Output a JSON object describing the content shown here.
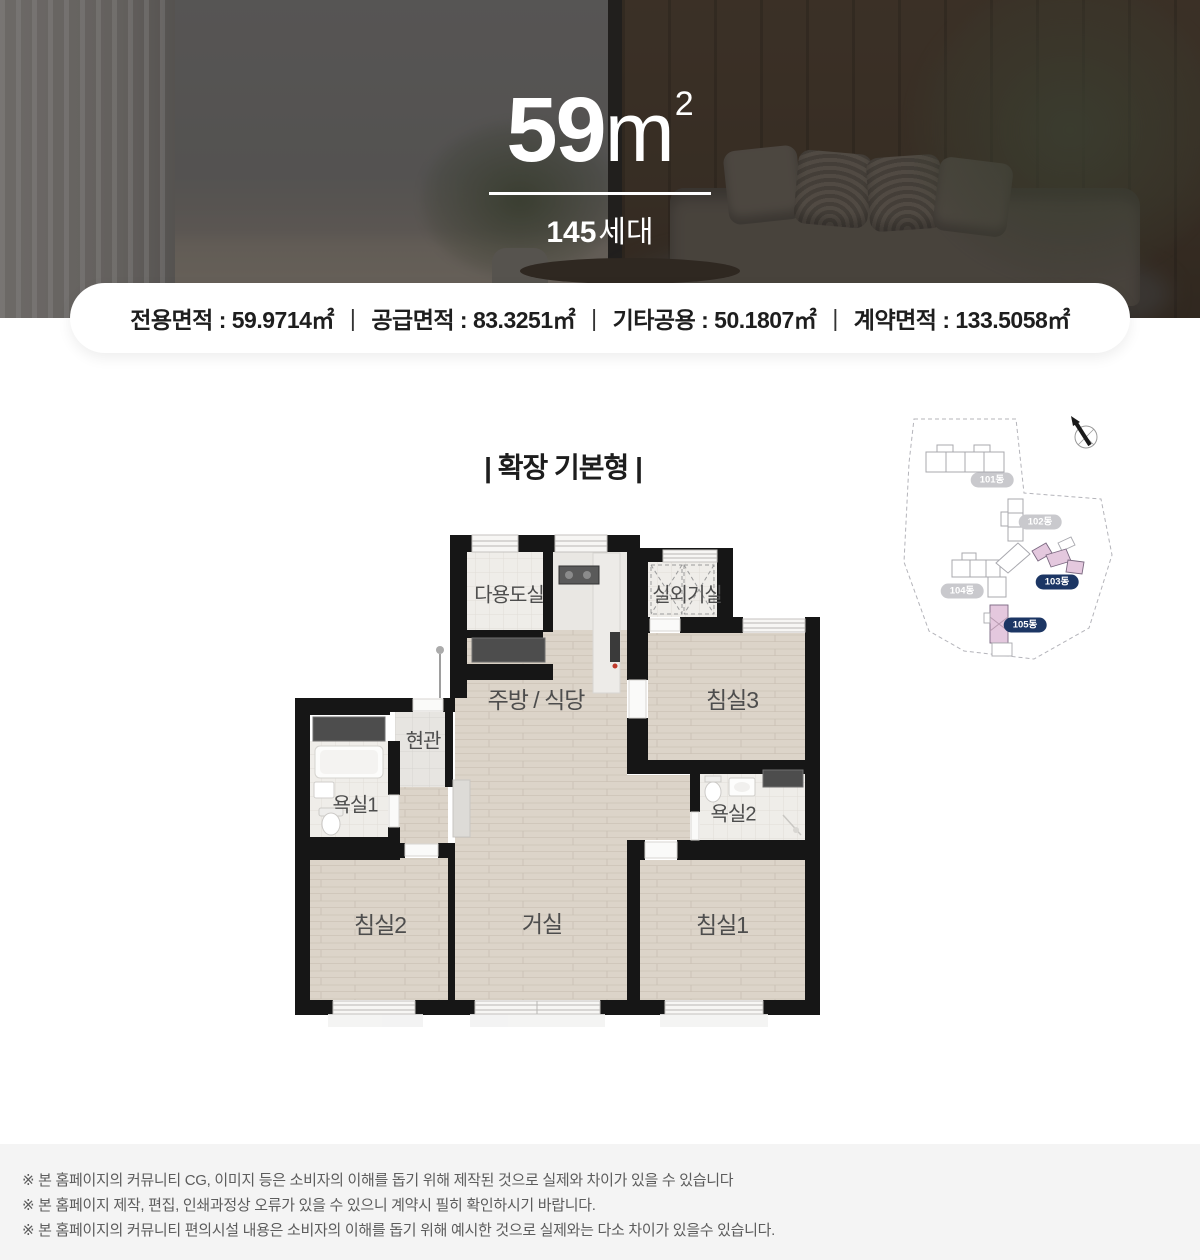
{
  "hero": {
    "area_number": "59",
    "area_unit": "m",
    "area_superscript": "2",
    "household_number": "145",
    "household_suffix": "세대"
  },
  "area_summary": {
    "divider": "|",
    "items": [
      "전용면적 : 59.9714㎡",
      "공급면적 : 83.3251㎡",
      "기타공용 : 50.1807㎡",
      "계약면적 : 133.5058㎡"
    ]
  },
  "plan": {
    "title": "| 확장 기본형 |",
    "rooms": {
      "utility": "다용도실",
      "ac_room": "실외기실",
      "kitchen": "주방 / 식당",
      "bedroom3": "침실3",
      "entrance": "현관",
      "bath1": "욕실1",
      "bath2": "욕실2",
      "bedroom2": "침실2",
      "living": "거실",
      "bedroom1": "침실1"
    }
  },
  "sitemap": {
    "compass_label": "N",
    "buildings": [
      {
        "label": "101동",
        "highlighted": false
      },
      {
        "label": "102동",
        "highlighted": false
      },
      {
        "label": "103동",
        "highlighted": true
      },
      {
        "label": "104동",
        "highlighted": false
      },
      {
        "label": "105동",
        "highlighted": true
      }
    ],
    "colors": {
      "highlight_pill": "#1c3664",
      "muted_pill": "#c9c9cd",
      "highlight_building": "#e4c8de"
    }
  },
  "footer": {
    "notes": [
      "※ 본 홈페이지의 커뮤니티 CG, 이미지 등은 소비자의 이해를 돕기 위해 제작된 것으로 실제와 차이가 있을 수 있습니다",
      "※ 본 홈페이지 제작, 편집, 인쇄과정상 오류가 있을 수 있으니 계약시 필히 확인하시기 바랍니다.",
      "※ 본 홈페이지의 커뮤니티 편의시설 내용은 소비자의 이해를 돕기 위해 예시한 것으로 실제와는 다소 차이가 있을수 있습니다."
    ]
  }
}
